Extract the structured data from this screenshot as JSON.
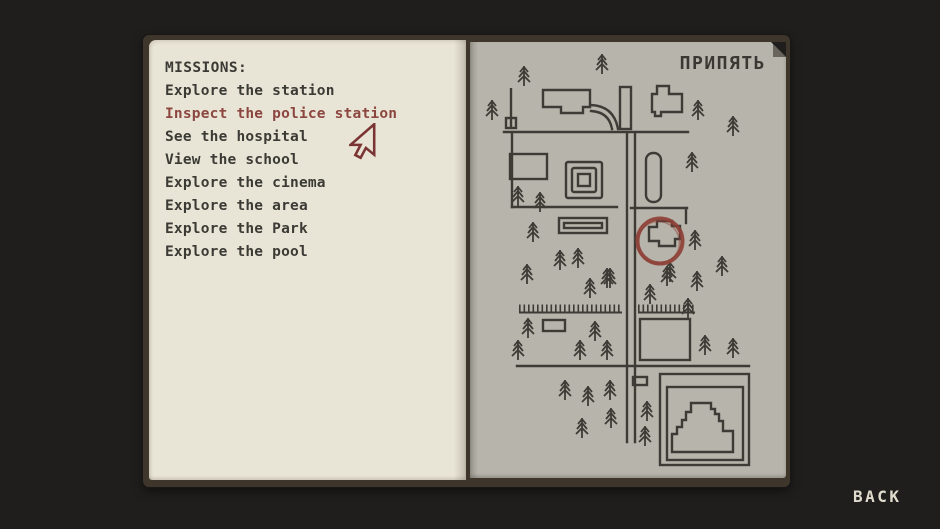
{
  "book": {
    "missions": {
      "heading": "MISSIONS:",
      "highlight_color": "#8c4640",
      "items": [
        {
          "label": "Explore the station",
          "highlighted": false
        },
        {
          "label": "Inspect the police station",
          "highlighted": true
        },
        {
          "label": "See the hospital",
          "highlighted": false
        },
        {
          "label": "View the school",
          "highlighted": false
        },
        {
          "label": "Explore the cinema",
          "highlighted": false
        },
        {
          "label": "Explore the area",
          "highlighted": false
        },
        {
          "label": "Explore the Park",
          "highlighted": false
        },
        {
          "label": "Explore the pool",
          "highlighted": false
        }
      ]
    },
    "map": {
      "title": "ПРИПЯТЬ",
      "marker_color": "#8d4036",
      "ink_color": "#3e3b36"
    }
  },
  "footer": {
    "back_label": "BACK"
  },
  "colors": {
    "background": "#1f1e1d",
    "page_left": "#e9e5d6",
    "page_right": "#b7b4ab",
    "book_cover": "#3f362b",
    "text": "#3c3a35"
  }
}
